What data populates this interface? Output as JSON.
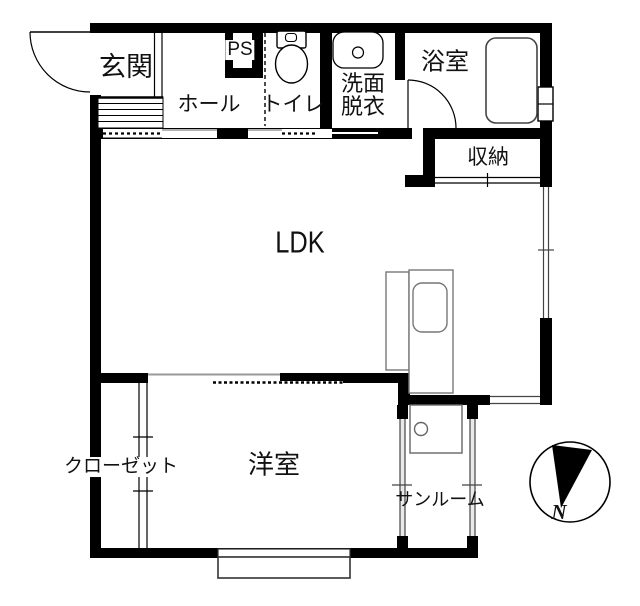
{
  "colors": {
    "wall": "#000000",
    "fixture_outline": "#777777",
    "glass_line": "#444444",
    "background": "#ffffff"
  },
  "rooms": {
    "genkan": {
      "label": "玄関"
    },
    "hall": {
      "label": "ホール"
    },
    "ps": {
      "label": "PS"
    },
    "toilet": {
      "label": "トイレ"
    },
    "washroom": {
      "line1": "洗面",
      "line2": "脱衣"
    },
    "bathroom": {
      "label": "浴室"
    },
    "storage": {
      "label": "収納"
    },
    "ldk": {
      "label": "LDK"
    },
    "closet": {
      "label": "クローゼット"
    },
    "western_room": {
      "label": "洋室"
    },
    "sunroom": {
      "label": "サンルーム"
    }
  },
  "compass": {
    "label": "N"
  }
}
